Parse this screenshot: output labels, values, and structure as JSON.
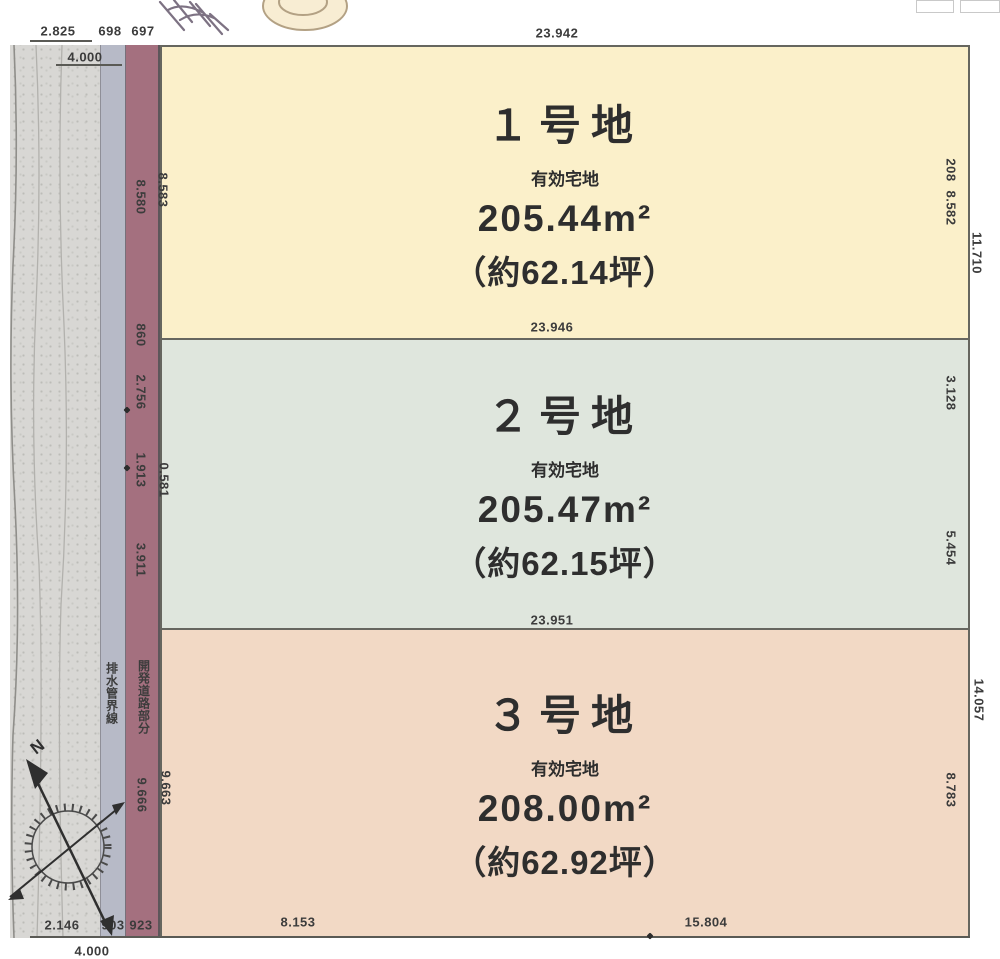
{
  "diagram": {
    "type": "land-subdivision-plot-map",
    "plots": [
      {
        "name": "１号地",
        "category": "有効宅地",
        "area_sqm": "205.44m²",
        "area_tsubo": "（約62.14坪）",
        "fill": "#fbf0ca"
      },
      {
        "name": "２号地",
        "category": "有効宅地",
        "area_sqm": "205.47m²",
        "area_tsubo": "（約62.15坪）",
        "fill": "#dfe6dd"
      },
      {
        "name": "３号地",
        "category": "有効宅地",
        "area_sqm": "208.00m²",
        "area_tsubo": "（約62.92坪）",
        "fill": "#f2d9c5"
      }
    ],
    "dims": {
      "top_width": "23.942",
      "top_seg_a": "2.825",
      "top_seg_b": "698",
      "top_seg_c": "697",
      "top_road_width": "4.000",
      "p1_bottom_width": "23.946",
      "p2_bottom_width": "23.951",
      "bottom_seg_a": "8.153",
      "bottom_seg_b": "15.804",
      "bottom_left_a": "2.146",
      "bottom_left_b": "903",
      "bottom_left_c": "923",
      "bottom_road_width": "4.000",
      "left_strip_p1": "8.580",
      "left_edge_p1": "8.583",
      "left_strip_860": "860",
      "left_strip_2756": "2.756",
      "left_strip_1913": "1.913",
      "left_edge_p2": "0.581",
      "left_strip_3911": "3.911",
      "left_strip_9666": "9.666",
      "left_edge_p3": "9.663",
      "right_p1_a": "208",
      "right_p1_b": "8.582",
      "right_p1_outer": "11.710",
      "right_p2_a": "3.128",
      "right_p2_b": "5.454",
      "right_p3_outer": "14.057",
      "right_p3_b": "8.783"
    },
    "strips": {
      "sidewalk_label": "排水管界線",
      "devstrip_label": "開発道路部分"
    },
    "compass": {
      "north": "N"
    },
    "colors": {
      "road": "#d8d7d4",
      "sidewalk": "#b7bac7",
      "dev_strip": "#a4707f",
      "plot1": "#fbf0ca",
      "plot2": "#dfe6dd",
      "plot3": "#f2d9c5",
      "outline": "#66665f"
    }
  }
}
